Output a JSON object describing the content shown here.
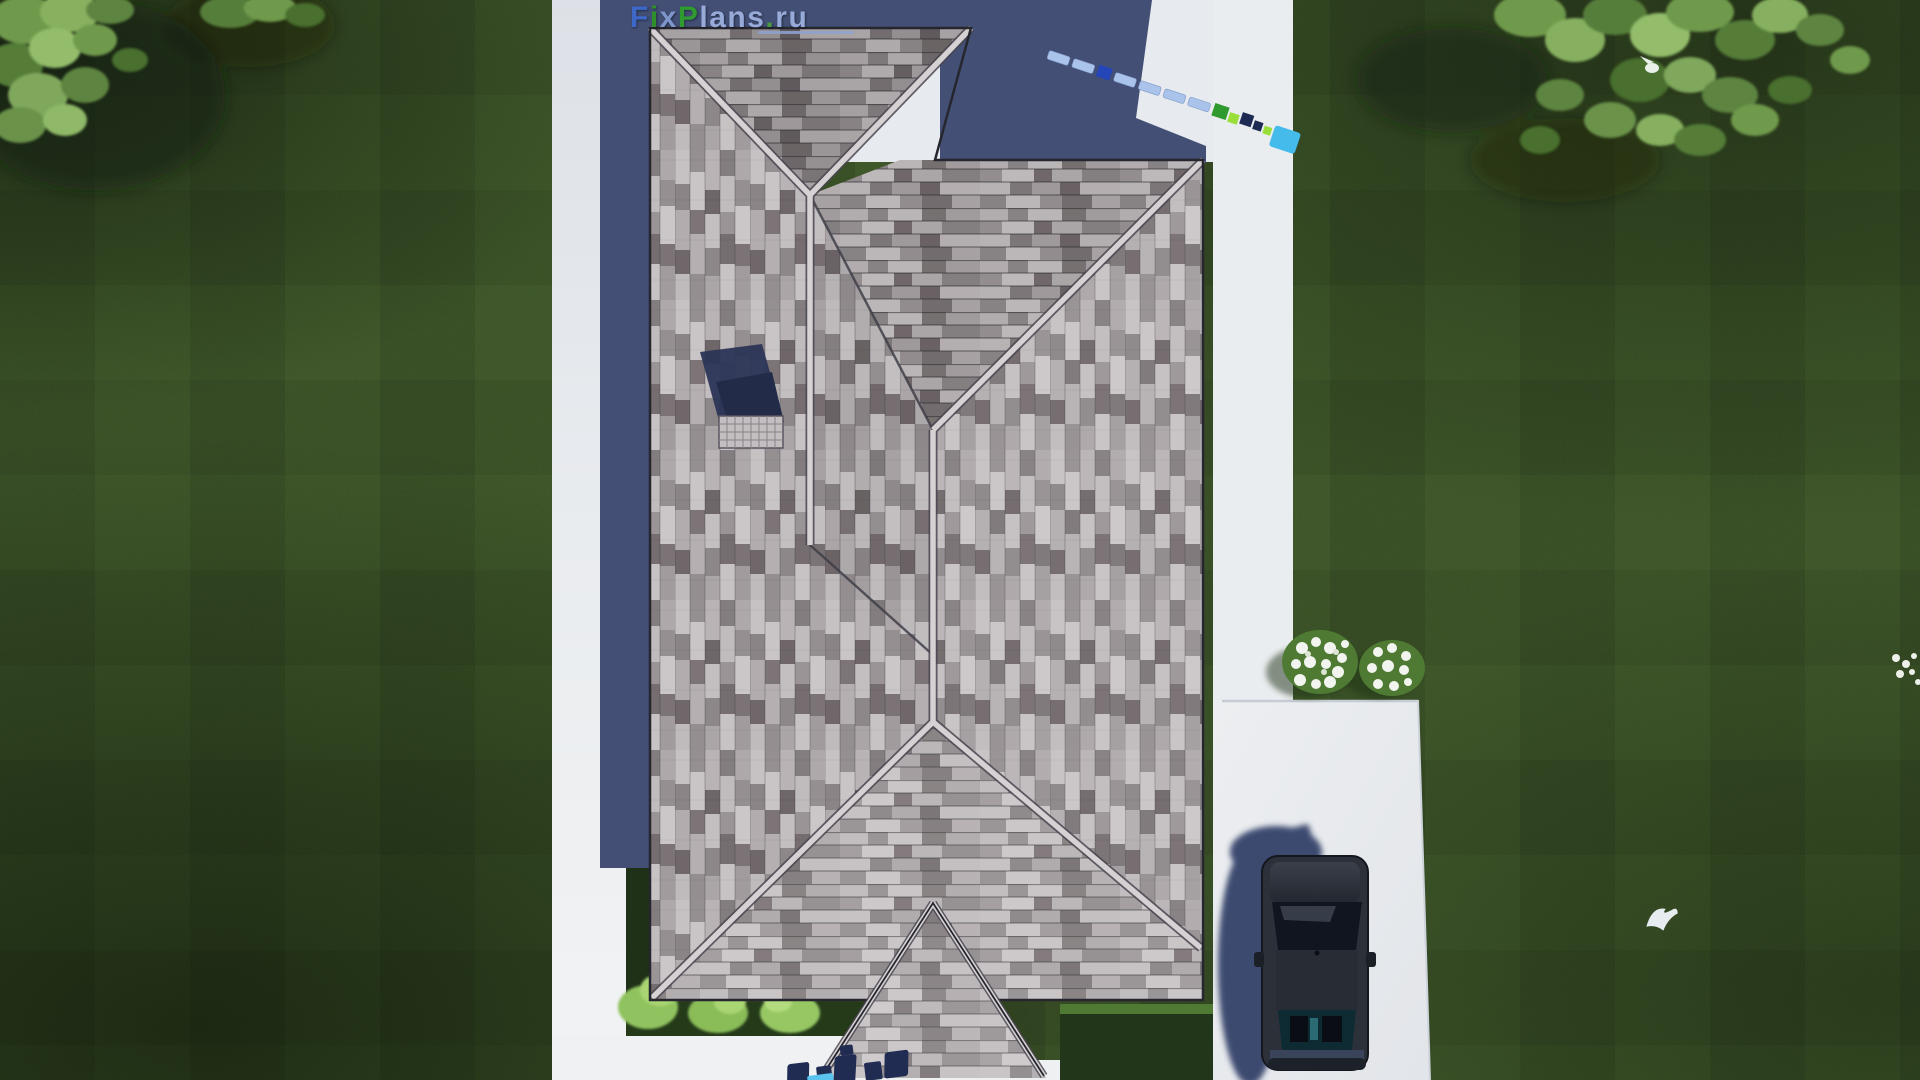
{
  "watermark": {
    "text": "FixPlans.ru",
    "letters": [
      {
        "char": "F",
        "color": "#3d68c8"
      },
      {
        "char": "i",
        "color": "#2f8f2a"
      },
      {
        "char": "x",
        "color": "#7e96cc"
      },
      {
        "char": "P",
        "color": "#2f9a30"
      },
      {
        "char": "l",
        "color": "#97aad8"
      },
      {
        "char": "a",
        "color": "#97aad8"
      },
      {
        "char": "n",
        "color": "#97aad8"
      },
      {
        "char": "s",
        "color": "#97aad8"
      },
      {
        "char": ".",
        "color": "#4a9a46"
      },
      {
        "char": "r",
        "color": "#97aad8"
      },
      {
        "char": "u",
        "color": "#97aad8"
      }
    ],
    "underline": true,
    "partial_bottom_text": "FixPl"
  },
  "scene": {
    "description": "Top-down aerial render of a single-family house with hip roof",
    "roof": {
      "type": "hip-roof-with-porch-gable",
      "shingle_colors": [
        "#cbc6c8",
        "#b2acae",
        "#958f91",
        "#7d7577",
        "#6b6365"
      ],
      "ridge_cap_color": "#d6d1d3",
      "chimney": "brick chimney with grid crown and navy cast shadow"
    },
    "ground": {
      "lawn_color": "#3a5226",
      "walkway_color": "#e9ecef",
      "shadow_color": "#434f75",
      "hedge_color": "#22361a",
      "bush_color": "#9ccb67"
    },
    "car": {
      "body_color": "#262a33",
      "location": "driveway bottom-right",
      "view": "top-down sedan"
    },
    "vegetation": {
      "trees": [
        "top-left canopy",
        "top-right canopy"
      ],
      "flower_bushes": {
        "count": 2,
        "flower_color": "#f2f4ef",
        "location": "right of house near driveway"
      }
    },
    "birds": [
      {
        "name": "bird-in-tree",
        "color": "#e9efe9"
      },
      {
        "name": "flying-bird",
        "color": "#e6ecef",
        "location": "lawn bottom-right"
      }
    ],
    "tape_watermark_colors": [
      "#a9c3ea",
      "#2446b8",
      "#2f9a2e",
      "#9ade3a",
      "#45bbec",
      "#1d2b52"
    ]
  }
}
